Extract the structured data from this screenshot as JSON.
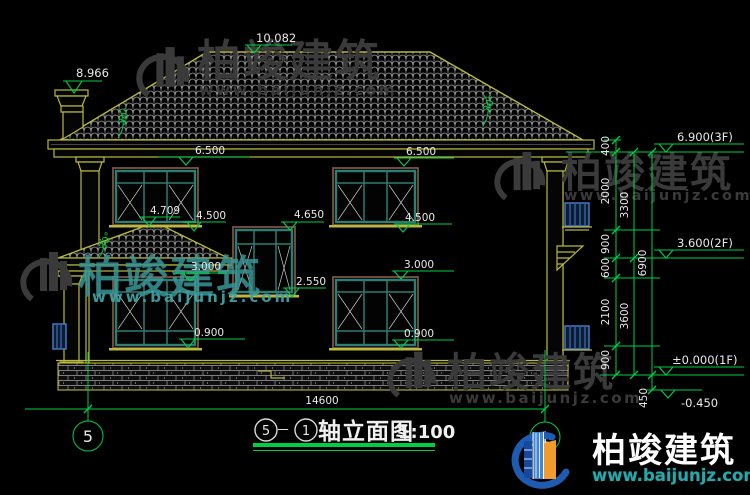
{
  "drawing_title": {
    "axis_left": "5",
    "separator": "－",
    "axis_right": "1",
    "title": "轴立面图",
    "scale": "1:100"
  },
  "axis_bubbles": {
    "left": "5",
    "right": "1"
  },
  "spot_levels": {
    "ridge": "10.082",
    "chimney": "8.966",
    "eave": "6.500",
    "porch_ridge": "4.709",
    "sill_2f": "4.500",
    "stair_head": "4.650",
    "stair_sill": "2.550",
    "head_1f": "3.000",
    "sill_1f": "0.900"
  },
  "roof_slope": "30°",
  "floor_levels": {
    "third": "6.900(3F)",
    "second": "3.600(2F)",
    "first": "±0.000(1F)",
    "grade": "-0.450"
  },
  "dimensions": {
    "overall_width": "14600",
    "right_chain": [
      "400",
      "2000",
      "900",
      "600",
      "2100",
      "900"
    ],
    "story_dims": [
      "3300",
      "3600"
    ],
    "total_height": "6900",
    "below_grade": "450"
  },
  "watermark": {
    "brand": "柏竣建筑",
    "site": "www.baijunjz.com"
  },
  "logo": {
    "brand": "柏竣建筑",
    "site": "www.baijunjz.com"
  },
  "colors": {
    "background": "#000000",
    "cad_yellow": "#b9b93c",
    "cad_green": "#00cf45",
    "window_teal": "#2e7d72",
    "frame_brown": "#7a5242",
    "detail_blue": "#4a7fd0",
    "watermark_gray": "#3a3a3a",
    "watermark_teal": "#3a9698",
    "logo_blue": "#1d5cb0",
    "logo_orange": "#f09b2b",
    "logo_url_teal": "#27a8aa"
  }
}
